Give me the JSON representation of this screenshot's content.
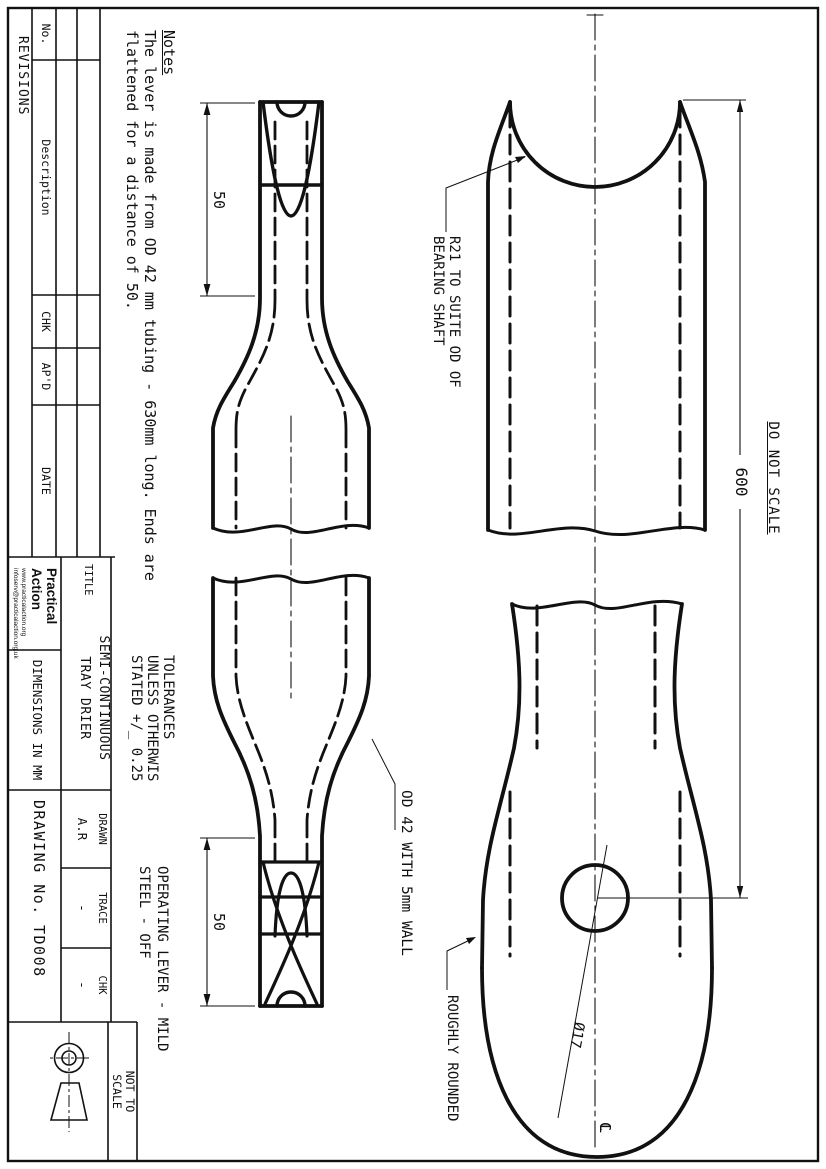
{
  "sheet": {
    "drawing_number": "TD008",
    "accent_color": "#111111",
    "paper_color": "#ffffff"
  },
  "revisions": {
    "title": "REVISIONS",
    "col_no": "No.",
    "col_description": "Description",
    "col_chk": "CHK",
    "col_apd": "AP'D",
    "col_date": "DATE"
  },
  "logo": {
    "line1": "Practical",
    "line2": "Action",
    "url1": "www.practicalaction.org",
    "url2": "infoserv@practicalaction.org.uk"
  },
  "title_block": {
    "title_label": "TITLE",
    "title_line1": "SEMI-CONTINUOUS",
    "title_line2": "TRAY DRIER",
    "drawn_label": "DRAWN",
    "drawn_value": "A.R",
    "trace_label": "TRACE",
    "trace_value": "-",
    "chk_label": "CHK",
    "chk_value": "-",
    "dimensions_note": "DIMENSIONS IN MM",
    "drawing_no_label": "DRAWING No.",
    "drawing_no_value": "TD008",
    "nts_line1": "NOT TO",
    "nts_line2": "SCALE",
    "projection_symbol": "first-angle-projection"
  },
  "notes": {
    "heading": "Notes",
    "line1": "The lever is made from OD 42 mm tubing - 630mm long. Ends are",
    "line2": "flattened for a distance of 50."
  },
  "tolerances": {
    "line1": "TOLERANCES",
    "line2": "UNLESS OTHERWIS",
    "line3": "STATED +/_ 0.25"
  },
  "annotations": {
    "do_not_scale": "DO NOT SCALE",
    "dim_600": "600",
    "dim_50_left": "50",
    "dim_50_right": "50",
    "r21_line1": "R21 TO SUITE OD OF",
    "r21_line2": "BEARING SHAFT",
    "od42": "OD 42 WITH 5mm WALL",
    "operating_line1": "OPERATING LEVER - MILD",
    "operating_line2": "STEEL - OFF",
    "roughly_rounded": "ROUGHLY ROUNDED",
    "dia17": "Ø17",
    "centerline_symbol": "CL"
  }
}
